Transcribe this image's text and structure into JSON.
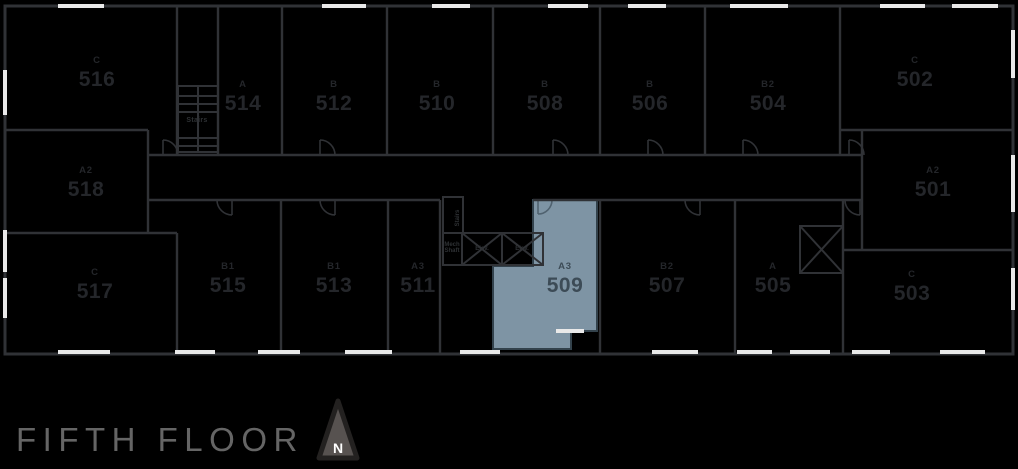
{
  "title": "FIFTH FLOOR",
  "compass": {
    "label": "N"
  },
  "colors": {
    "background": "#000000",
    "wall": "#303236",
    "window": "#E9E9E9",
    "unit_label": "#24262A",
    "highlight_fill": "#7E94A4",
    "highlight_outline": "#33424C",
    "highlight_door": "#50626F",
    "highlight_label": "#3C4B56",
    "service_label": "#2E3134",
    "title_text": "#656565",
    "compass_fill": "#575250",
    "compass_outline": "#232120",
    "compass_letter": "#FFFFFF"
  },
  "highlighted_unit": {
    "number": "509",
    "type": "A3"
  },
  "units": [
    {
      "number": "516",
      "type": "C",
      "x": 97,
      "y": 56,
      "highlighted": false
    },
    {
      "number": "514",
      "type": "A",
      "x": 243,
      "y": 80,
      "highlighted": false
    },
    {
      "number": "512",
      "type": "B",
      "x": 334,
      "y": 80,
      "highlighted": false
    },
    {
      "number": "510",
      "type": "B",
      "x": 437,
      "y": 80,
      "highlighted": false
    },
    {
      "number": "508",
      "type": "B",
      "x": 545,
      "y": 80,
      "highlighted": false
    },
    {
      "number": "506",
      "type": "B",
      "x": 650,
      "y": 80,
      "highlighted": false
    },
    {
      "number": "504",
      "type": "B2",
      "x": 768,
      "y": 80,
      "highlighted": false
    },
    {
      "number": "502",
      "type": "C",
      "x": 915,
      "y": 56,
      "highlighted": false
    },
    {
      "number": "518",
      "type": "A2",
      "x": 86,
      "y": 166,
      "highlighted": false
    },
    {
      "number": "501",
      "type": "A2",
      "x": 933,
      "y": 166,
      "highlighted": false
    },
    {
      "number": "517",
      "type": "C",
      "x": 95,
      "y": 268,
      "highlighted": false
    },
    {
      "number": "515",
      "type": "B1",
      "x": 228,
      "y": 262,
      "highlighted": false
    },
    {
      "number": "513",
      "type": "B1",
      "x": 334,
      "y": 262,
      "highlighted": false
    },
    {
      "number": "511",
      "type": "A3",
      "x": 418,
      "y": 262,
      "highlighted": false
    },
    {
      "number": "509",
      "type": "A3",
      "x": 565,
      "y": 262,
      "highlighted": true
    },
    {
      "number": "507",
      "type": "B2",
      "x": 667,
      "y": 262,
      "highlighted": false
    },
    {
      "number": "505",
      "type": "A",
      "x": 773,
      "y": 262,
      "highlighted": false
    },
    {
      "number": "503",
      "type": "C",
      "x": 912,
      "y": 270,
      "highlighted": false
    }
  ],
  "service": {
    "stairs_top": "Stairs",
    "stairs_mid": "Stairs",
    "mech_shaft": "Mech Shaft",
    "elevator_1": "Elev.",
    "elevator_2": "Elev."
  }
}
